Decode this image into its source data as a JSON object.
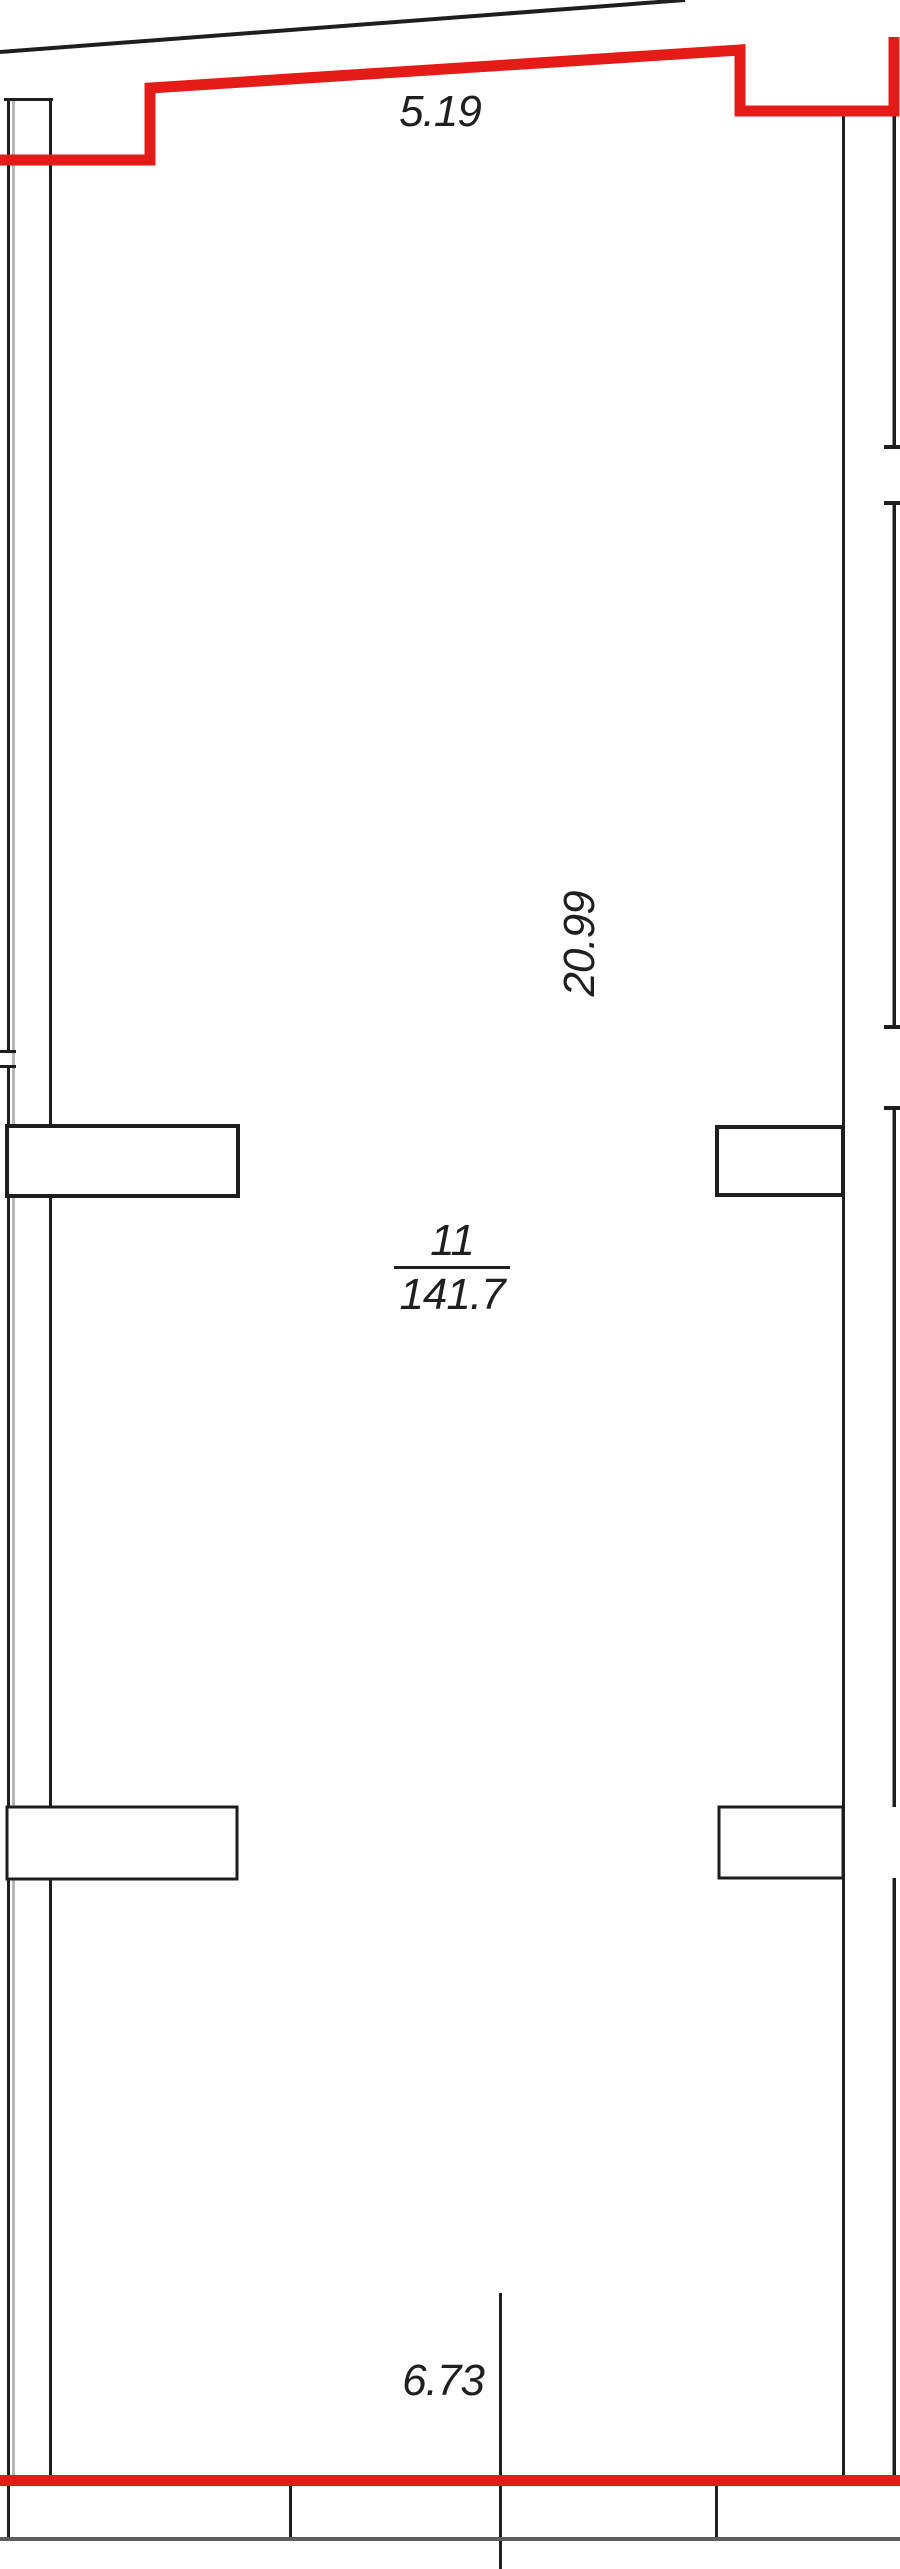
{
  "drawing": {
    "room": {
      "number": "11",
      "area": "141.7"
    },
    "dimensions": {
      "top_width": "5.19",
      "side_height": "20.99",
      "bottom_width": "6.73"
    },
    "colors": {
      "highlight_red": "#e41b17",
      "wall_black": "#1e1e1e",
      "lower_level_gray": "#5d5d5d"
    }
  }
}
